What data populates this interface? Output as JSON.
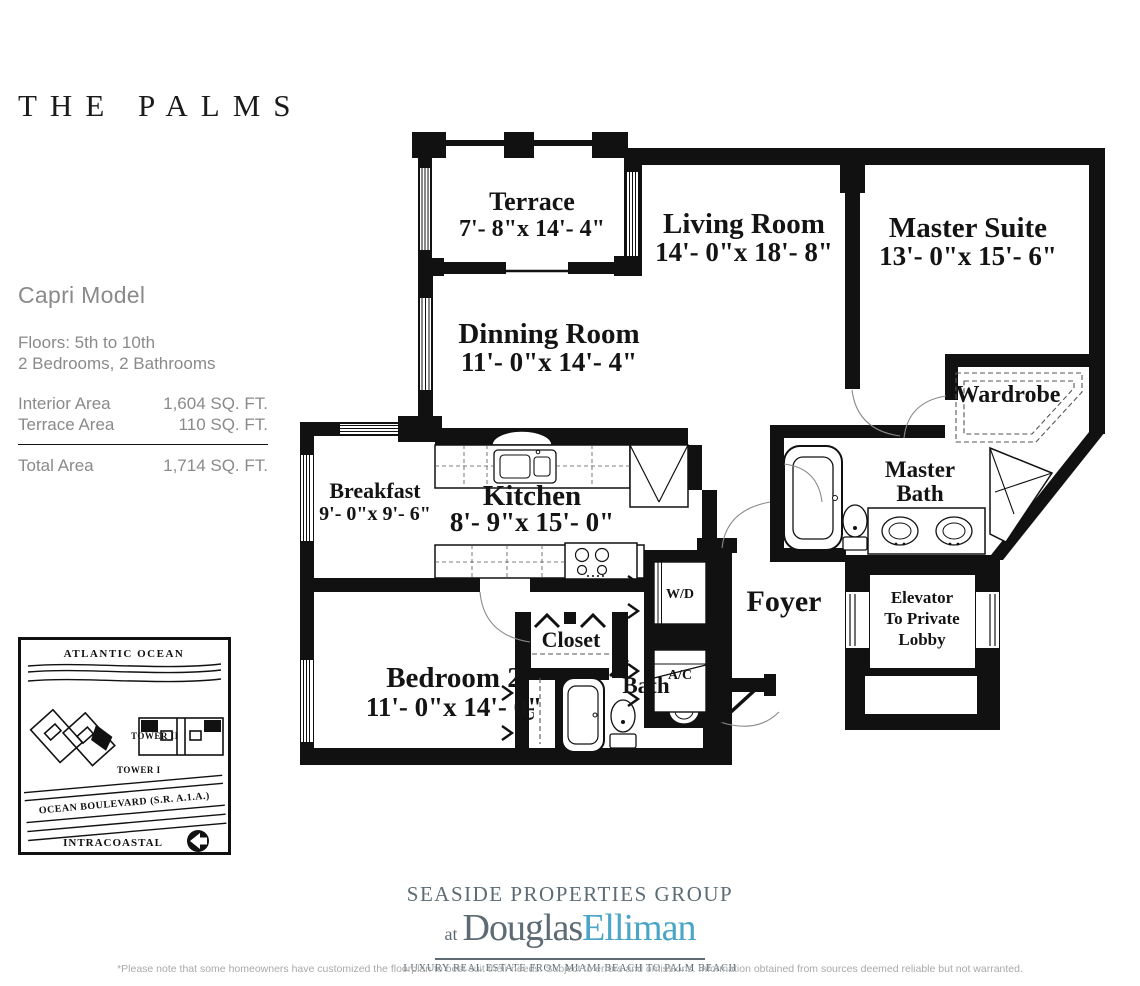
{
  "page": {
    "title": "THE PALMS"
  },
  "model": {
    "name": "Capri Model",
    "floors": "Floors: 5th to 10th",
    "bed_bath": "2 Bedrooms, 2 Bathrooms",
    "areas": [
      {
        "label": "Interior Area",
        "value": "1,604 SQ. FT."
      },
      {
        "label": "Terrace Area",
        "value": "110 SQ. FT."
      }
    ],
    "total": {
      "label": "Total Area",
      "value": "1,714 SQ. FT."
    }
  },
  "floorplan": {
    "rooms": {
      "terrace": {
        "name": "Terrace",
        "dims": "7'- 8\"x 14'- 4\""
      },
      "living": {
        "name": "Living Room",
        "dims": "14'- 0\"x 18'- 8\""
      },
      "master_suite": {
        "name": "Master Suite",
        "dims": "13'- 0\"x 15'- 6\""
      },
      "dinning": {
        "name": "Dinning Room",
        "dims": "11'- 0\"x 14'- 4\""
      },
      "wardrobe": {
        "name": "Wardrobe"
      },
      "breakfast": {
        "name": "Breakfast",
        "dims": "9'- 0\"x 9'- 6\""
      },
      "kitchen": {
        "name": "Kitchen",
        "dims": "8'- 9\"x 15'- 0\""
      },
      "master_bath": {
        "line1": "Master",
        "line2": "Bath"
      },
      "wd": {
        "name": "W/D"
      },
      "foyer": {
        "name": "Foyer"
      },
      "elevator": {
        "line1": "Elevator",
        "line2": "To Private",
        "line3": "Lobby"
      },
      "bedroom2": {
        "name": "Bedroom 2",
        "dims": "11'- 0\"x 14'- 0\""
      },
      "closet": {
        "name": "Closet"
      },
      "ac": {
        "name": "A/C"
      },
      "bath": {
        "name": "Bath"
      },
      "linen": {
        "name": "Cl"
      }
    }
  },
  "sitemap": {
    "ocean": "ATLANTIC OCEAN",
    "tower2": "TOWER II",
    "tower1": "TOWER I",
    "road": "OCEAN BOULEVARD  (S.R. A.1.A.)",
    "intracoastal": "INTRACOASTAL"
  },
  "footer": {
    "group": "SEASIDE PROPERTIES GROUP",
    "at": "at",
    "brand1": "Douglas",
    "brand2": "Elliman",
    "tagline": "LUXURY REAL ESTATE FROM MIAMI BEACH TO PALM BEACH",
    "disclaimer": "*Please note that some homeowners have customized the floorplan to best suit their needs. Subject to errors and omissions. Information obtained from sources deemed reliable but not warranted.",
    "text_color": "#5d6b74",
    "brand_color": "#4aa5c6",
    "plan_color": "#111111"
  }
}
